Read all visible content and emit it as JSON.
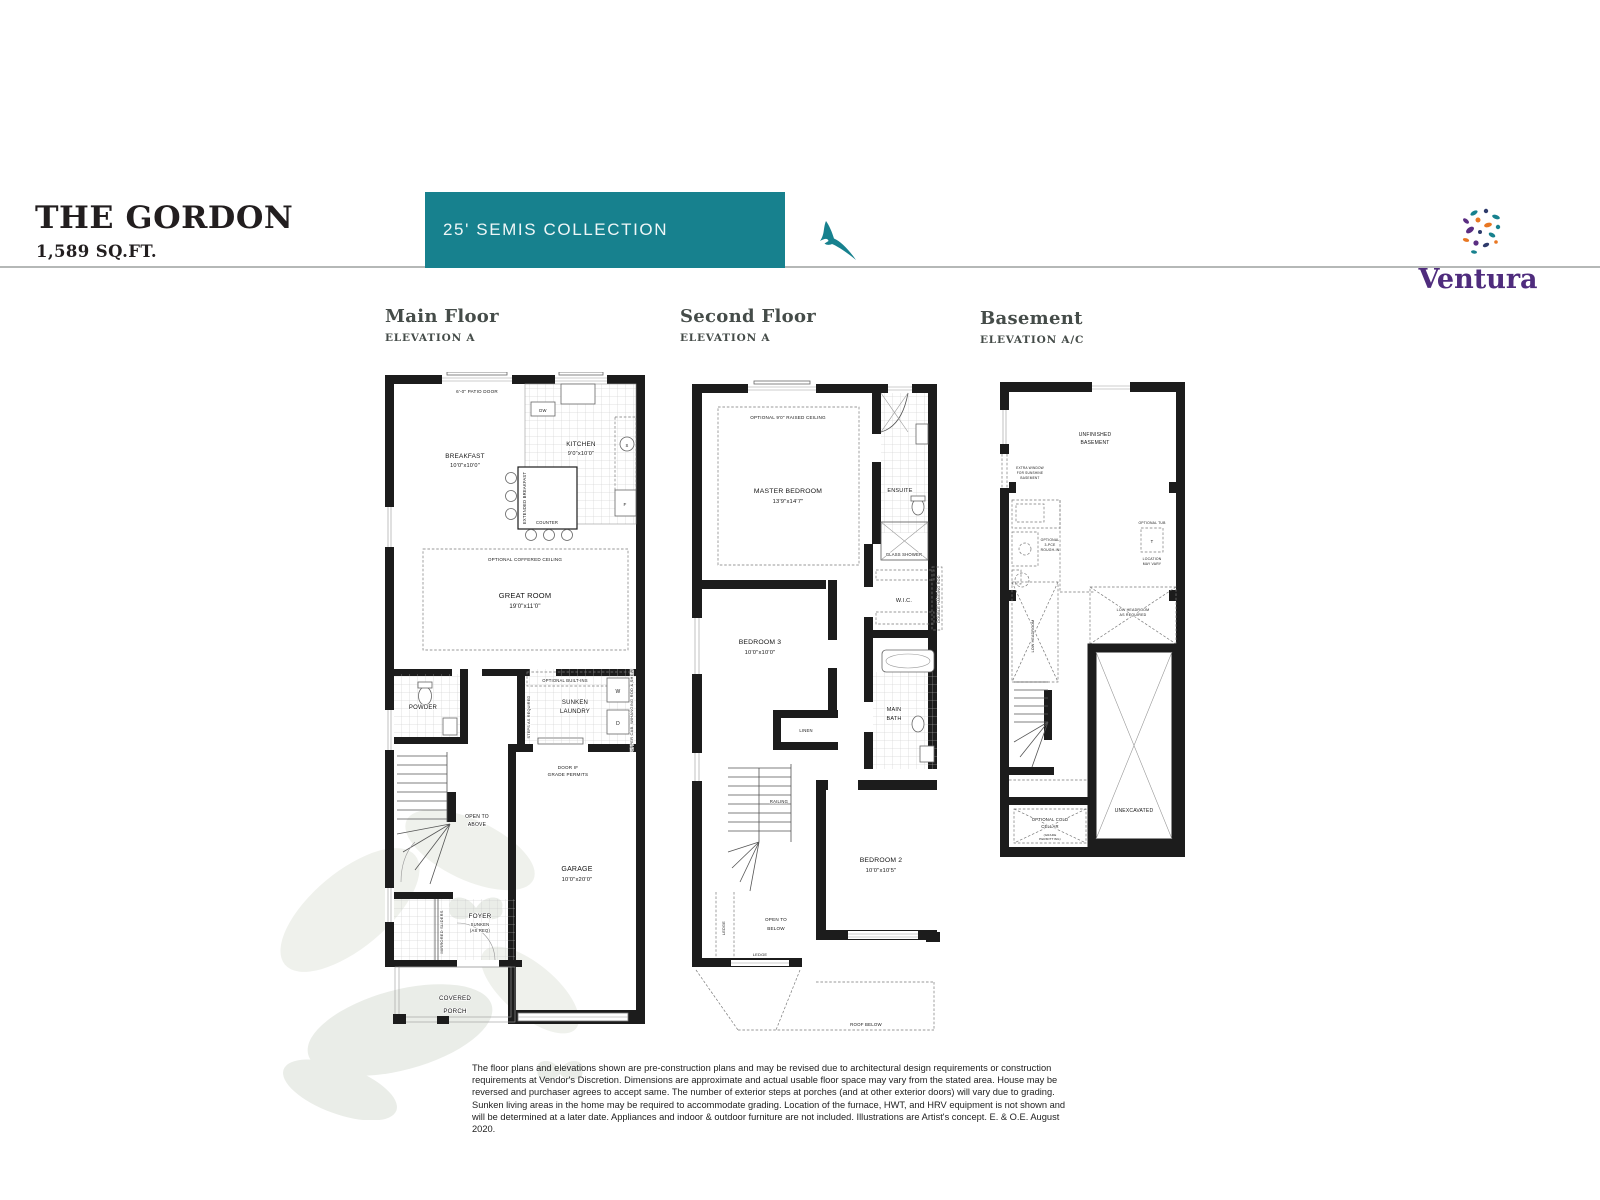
{
  "header": {
    "title": "THE GORDON",
    "sqft": "1,589 SQ.FT.",
    "collection": "25' SEMIS COLLECTION",
    "brand": "Ventura",
    "accent_teal": "#17818e",
    "brand_purple": "#4f2c7d"
  },
  "plan_headings": {
    "main": {
      "name": "Main Floor",
      "elevation": "ELEVATION A"
    },
    "second": {
      "name": "Second Floor",
      "elevation": "ELEVATION A"
    },
    "basement": {
      "name": "Basement",
      "elevation": "ELEVATION A/C"
    }
  },
  "main": {
    "patio_door": "6'-0\" PATIO DOOR",
    "breakfast": "BREAKFAST",
    "breakfast_dim": "10'0\"x10'0\"",
    "kitchen": "KITCHEN",
    "kitchen_dim": "9'0\"x10'0\"",
    "dw": "DW",
    "counter": "COUNTER",
    "extended_breakfast": "EXTENDED BREAKFAST",
    "fridge": "F",
    "sink": "S",
    "coffered": "OPTIONAL COFFERED CEILING",
    "great_room": "GREAT ROOM",
    "great_room_dim": "19'0\"x11'0\"",
    "powder": "POWDER",
    "optional_builtins": "OPTIONAL BUILT-INS",
    "sunken": "SUNKEN",
    "laundry": "LAUNDRY",
    "steps_required": "STEPS AS REQUIRED",
    "washer": "W",
    "dryer": "D",
    "upper_cab": "UPPER CAB. W/HANGING ROD & SHELF",
    "door_if": "DOOR IF",
    "grade_permits": "GRADE PERMITS",
    "open_to": "OPEN TO",
    "above": "ABOVE",
    "garage": "GARAGE",
    "garage_dim": "10'0\"x20'0\"",
    "foyer": "FOYER",
    "foyer_sunken": "SUNKEN",
    "foyer_asreq": "(AS REQ)",
    "mirrored_sliders": "MIRRORED SLIDERS",
    "covered": "COVERED",
    "porch": "PORCH"
  },
  "second": {
    "raised_ceiling": "OPTIONAL 9'0\" RAISED CEILING",
    "master": "MASTER BEDROOM",
    "master_dim": "13'9\"x14'7\"",
    "ensuite": "ENSUITE",
    "glass_shower": "GLASS SHOWER",
    "wic": "W.I.C.",
    "double_rod": "DOUBLE HANGING ROD",
    "bedroom3": "BEDROOM 3",
    "bedroom3_dim": "10'0\"x10'0\"",
    "linen": "LINEN",
    "main_word": "MAIN",
    "bath_word": "BATH",
    "railing": "RAILING",
    "open_to": "OPEN TO",
    "below": "BELOW",
    "ledge_v": "LEDGE",
    "ledge_h": "LEDGE",
    "bedroom2": "BEDROOM 2",
    "bedroom2_dim": "10'0\"x10'5\"",
    "roof_below": "ROOF BELOW"
  },
  "basement": {
    "unfinished": "UNFINISHED",
    "basement_word": "BASEMENT",
    "extra1": "EXTRA WINDOW",
    "extra2": "FOR SUNSHINE",
    "extra3": "BASEMENT",
    "rough1": "OPTIONAL",
    "rough2": "3-PCE",
    "rough3": "ROUGH-IN",
    "tub": "OPTIONAL TUB",
    "tub_t": "T",
    "loc1": "LOCATION",
    "loc2": "MAY VARY",
    "lowhead_v": "LOW HEADROOM",
    "lowhead1": "LOW HEADROOM",
    "lowhead2": "AS REQUIRED",
    "unexcavated": "UNEXCAVATED",
    "cold1": "OPTIONAL COLD",
    "cold2": "CELLAR",
    "grade1": "(GRADE",
    "grade2": "PERMITTING)"
  },
  "disclaimer": {
    "text": "The floor plans and elevations shown are pre-construction plans and may be revised due to architectural design requirements or construction requirements at Vendor's Discretion. Dimensions are approximate and actual usable floor space may vary from the stated area. House may be reversed and purchaser agrees to accept same. The number of exterior steps at porches (and at other exterior doors) will vary due to grading. Sunken living areas in the home may be required to accommodate grading. Location of the furnace, HWT, and HRV equipment is not shown and will be determined at a later date. Appliances and indoor & outdoor furniture are not included. Illustrations are Artist's concept. E. & O.E. August 2020."
  }
}
